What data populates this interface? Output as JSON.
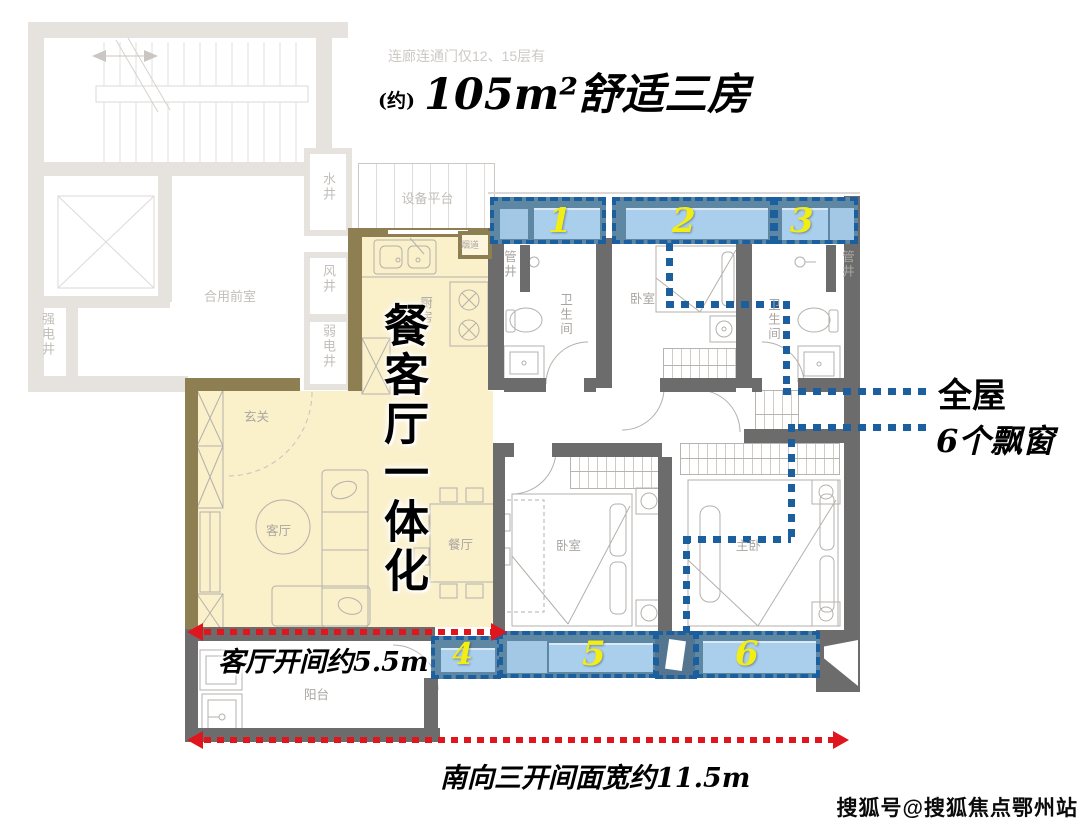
{
  "header": {
    "note": "连廊连通门仅12、15层有",
    "title_prefix": "(约)",
    "title": "105m²舒适三房"
  },
  "rooms": {
    "shared_front_room": "合用前室",
    "strong_elec_shaft": "强电井",
    "water_shaft": "水井",
    "wind_shaft": "风井",
    "weak_elec_shaft": "弱电井",
    "equipment_platform": "设备平台",
    "flue": "烟道",
    "kitchen": "厨房",
    "pipe_shaft_left": "管井",
    "pipe_shaft_right": "管井",
    "bath_left": "卫生间",
    "bath_right": "卫生间",
    "bedroom_top": "卧室",
    "bedroom_bottom": "卧室",
    "master_bedroom": "主卧",
    "entry": "玄关",
    "living": "客厅",
    "dining": "餐厅",
    "balcony": "阳台"
  },
  "bay_windows": [
    "1",
    "2",
    "3",
    "4",
    "5",
    "6"
  ],
  "callouts": {
    "integration_vertical": "餐客厅一体化",
    "whole_house_line1": "全屋",
    "whole_house_line2": "6个飘窗",
    "living_width": "客厅开间约5.5m",
    "south_facing_width": "南向三开间面宽约11.5m"
  },
  "watermark": "搜狐号@搜狐焦点鄂州站",
  "colors": {
    "highlight_fill": "#FAF0CA",
    "highlight_wall": "#8D7F51",
    "bay_window_fill": "#AACFEC",
    "bay_window_dark": "#5D87A3",
    "bay_dotted_blue": "#1C5F9F",
    "arrow_red": "#E0161F",
    "number_yellow": "#F2EE14",
    "wall_dark": "#6C6C6C",
    "wall_light": "#E6E2DE"
  }
}
